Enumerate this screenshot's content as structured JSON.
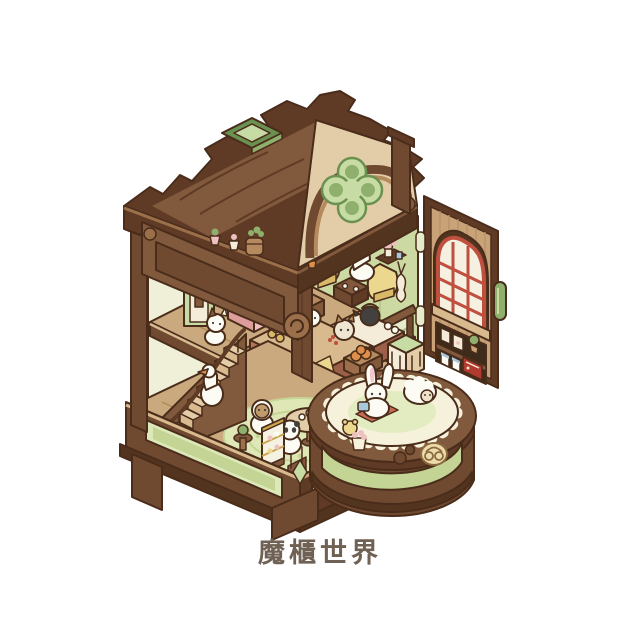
{
  "page": {
    "background_color": "#ffffff"
  },
  "caption": {
    "text": "魔櫃世界",
    "color": "#6f6153"
  },
  "palette": {
    "bg": "#ffffff",
    "outline": "#4a2c1b",
    "woodDarkest": "#53341f",
    "woodDark": "#5f3b26",
    "wood": "#6f4a31",
    "woodMid": "#81593c",
    "woodLight": "#9a6f4a",
    "woodPale": "#b58a5e",
    "tan": "#c9a377",
    "tanLight": "#d8ba8e",
    "cream": "#e3cda9",
    "creamLight": "#f4ecd8",
    "wallPale": "#f0efd8",
    "wallGreen": "#ccd9a3",
    "green": "#8fb06c",
    "greenDark": "#6b9150",
    "greenLight": "#c7dca4",
    "greenPale": "#e6eccb",
    "panelGreen": "#c3d494",
    "panelGreenLight": "#dce8b8",
    "red": "#bf4f3e",
    "radioRed": "#b23a2f",
    "yellow": "#ecd78f",
    "yellowDeep": "#d9b968",
    "pink": "#eec0c0",
    "pinkDeep": "#dd9d9a",
    "orange": "#dd8f4a",
    "charWhite": "#fdfcf4",
    "black": "#42413e",
    "blue": "#a7c8dc",
    "gold": "#caa54e",
    "rug": "#dfe7b6",
    "rugLine": "#c6d595",
    "floor": "#c9a97d",
    "brick": "#b5745a",
    "brickLine": "#9c5f47",
    "text": "#6f6153"
  },
  "scene": {
    "type": "isometric-cabinet-dollhouse-illustration",
    "subject": "magic cabinet world: a wooden curio cabinet opened to reveal a three-floor animal cafe",
    "roof": {
      "skylight": "green diamond window",
      "pediment_window": "green clover stained glass"
    },
    "floors": [
      {
        "name": "attic-lounge",
        "details": "white goose and cat having tea on yellow armchairs, wall shelves with plants, green railing, pink cabinet and arched mirror"
      },
      {
        "name": "middle-bakery",
        "details": "brick pastry counters with bread and cakes, shiba and puppy bakers, black kettle, pumpkin crate, green hutch"
      },
      {
        "name": "ground-cafe",
        "details": "round green rug, tea table with panda, capybara and broccoli characters, staircase with duck, golden dessert display case and cart"
      }
    ],
    "door": {
      "side": "right-open",
      "window": "arched red-paned window",
      "shelves": "photo frames, potted plant, drink cups, red radio",
      "handle": "green pill handle",
      "hinges": 2
    },
    "balcony": {
      "details": "white rabbit with blue toy and fluffy sheep on a scalloped cream rug",
      "drum": "brown drum with green panel and golden pretzel emblem"
    },
    "base": {
      "details": "brown plinth with light green inset panels, green diamond ornament, bracket feet"
    }
  }
}
